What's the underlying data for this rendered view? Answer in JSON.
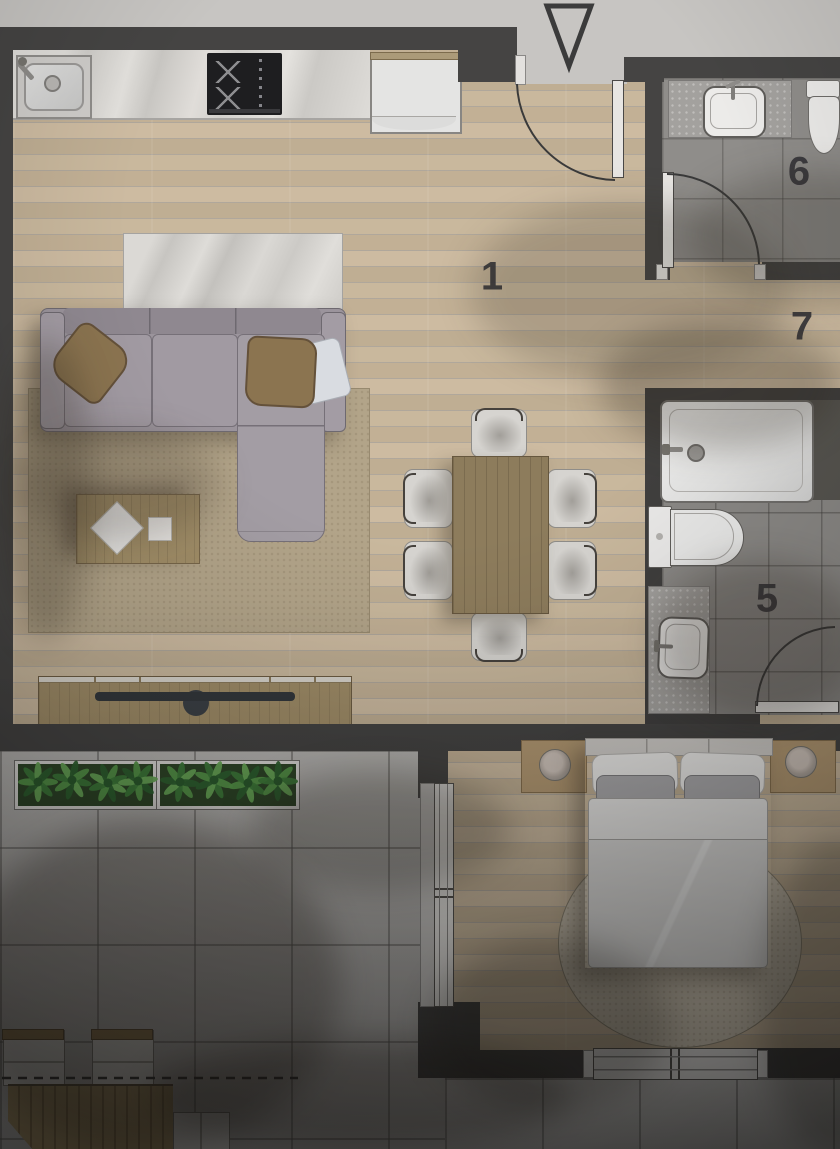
{
  "plan": {
    "title": "apartment-floor-plan",
    "rooms": [
      {
        "label": "1",
        "name": "living-dining-kitchen"
      },
      {
        "label": "5",
        "name": "ensuite-bathroom"
      },
      {
        "label": "6",
        "name": "guest-wc"
      },
      {
        "label": "7",
        "name": "hallway"
      }
    ],
    "markers": [
      {
        "name": "entrance-triangle-marker"
      },
      {
        "name": "terrace-boundary-dashed-line"
      }
    ],
    "fixtures": [
      "kitchen-sink",
      "cooktop",
      "refrigerator",
      "sofa",
      "throw-pillows",
      "area-rug",
      "coffee-table",
      "tv-console",
      "tv",
      "dining-table",
      "dining-chairs",
      "entrance-door",
      "wc-washbasin",
      "wc-toilet",
      "bathtub",
      "bathroom-toilet",
      "bathroom-washbasin",
      "bed",
      "nightstand-lamps",
      "round-rug",
      "bedroom-window",
      "terrace-planters",
      "outdoor-table",
      "outdoor-chairs"
    ],
    "colors": {
      "wall": "#454443",
      "wood_floor": "#c4b297",
      "bath_tile": "#8d8b88",
      "terrace_tile": "#b3b1ae",
      "marble": "#dcdad7",
      "plant_green": "#4c8a44",
      "rug_beige": "#b2a489",
      "sofa_gray": "#9b949c",
      "label_color": "#37363a"
    }
  }
}
